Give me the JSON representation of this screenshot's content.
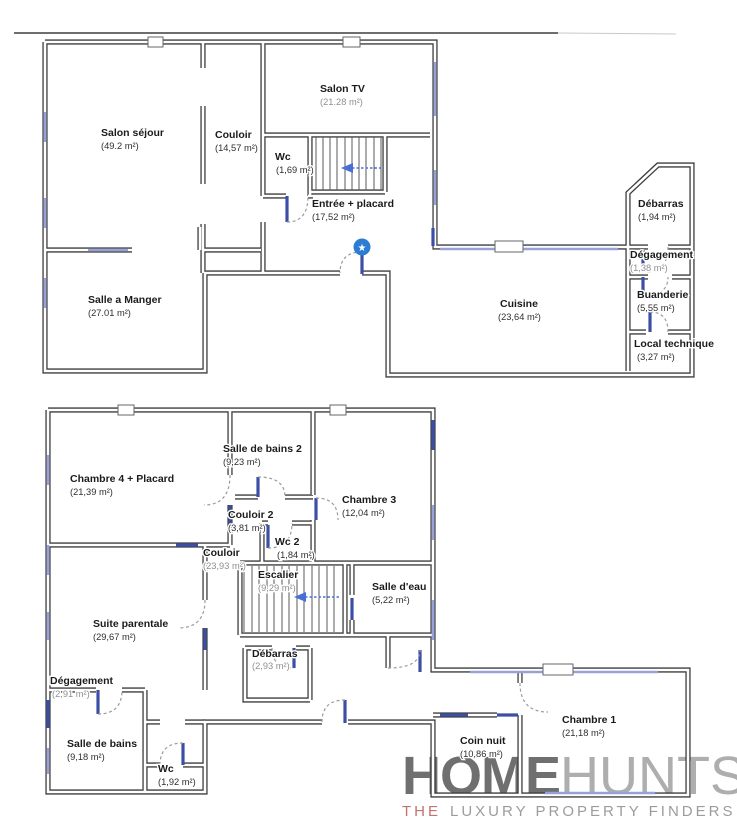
{
  "floor1": {
    "rooms": [
      {
        "name": "Salon séjour",
        "area": "(49.2 m²)"
      },
      {
        "name": "Couloir",
        "area": "(14,57 m²)"
      },
      {
        "name": "Salon TV",
        "area": "(21.28 m²)"
      },
      {
        "name": "Wc",
        "area": "(1,69 m²)"
      },
      {
        "name": "Entrée + placard",
        "area": "(17,52 m²)"
      },
      {
        "name": "Salle a Manger",
        "area": "(27.01 m²)"
      },
      {
        "name": "Cuisine",
        "area": "(23,64 m²)"
      },
      {
        "name": "Débarras",
        "area": "(1,94 m²)"
      },
      {
        "name": "Dégagement",
        "area": "(1,38 m²)"
      },
      {
        "name": "Buanderie",
        "area": "(5,55 m²)"
      },
      {
        "name": "Local technique",
        "area": "(3,27 m²)"
      }
    ]
  },
  "floor2": {
    "rooms": [
      {
        "name": "Chambre 4 + Placard",
        "area": "(21,39 m²)"
      },
      {
        "name": "Salle de bains 2",
        "area": "(9,23 m²)"
      },
      {
        "name": "Chambre 3",
        "area": "(12,04 m²)"
      },
      {
        "name": "Couloir 2",
        "area": "(3,81 m²)"
      },
      {
        "name": "Couloir",
        "area": "(23,93 m²)"
      },
      {
        "name": "Wc 2",
        "area": "(1,84 m²)"
      },
      {
        "name": "Escalier",
        "area": "(9,29 m²)"
      },
      {
        "name": "Salle d'eau",
        "area": "(5,22 m²)"
      },
      {
        "name": "Suite parentale",
        "area": "(29,67 m²)"
      },
      {
        "name": "Débarras",
        "area": "(2,93 m²)"
      },
      {
        "name": "Dégagement",
        "area": "(2,91 m²)"
      },
      {
        "name": "Salle de bains",
        "area": "(9,18 m²)"
      },
      {
        "name": "Wc",
        "area": "(1,92 m²)"
      },
      {
        "name": "Coin nuit",
        "area": "(10,86 m²)"
      },
      {
        "name": "Chambre 1",
        "area": "(21,18 m²)"
      }
    ]
  },
  "markers": {
    "entrance_star_glyph": "★"
  },
  "watermark": {
    "home": "HOME",
    "hunts": "HUNTS",
    "the": "THE",
    "tagline": "LUXURY PROPERTY FINDERS"
  },
  "colors": {
    "wall": "#3d3d3d",
    "window": "#98a1d8",
    "door": "#3d4fa5",
    "star": "#2b7cd3",
    "arrow": "#4a6fd4",
    "logo_home": "#6f6f6f",
    "logo_hunts": "#aeaeae",
    "logo_the": "#c0736f",
    "logo_tagline": "#9c9c9c"
  }
}
